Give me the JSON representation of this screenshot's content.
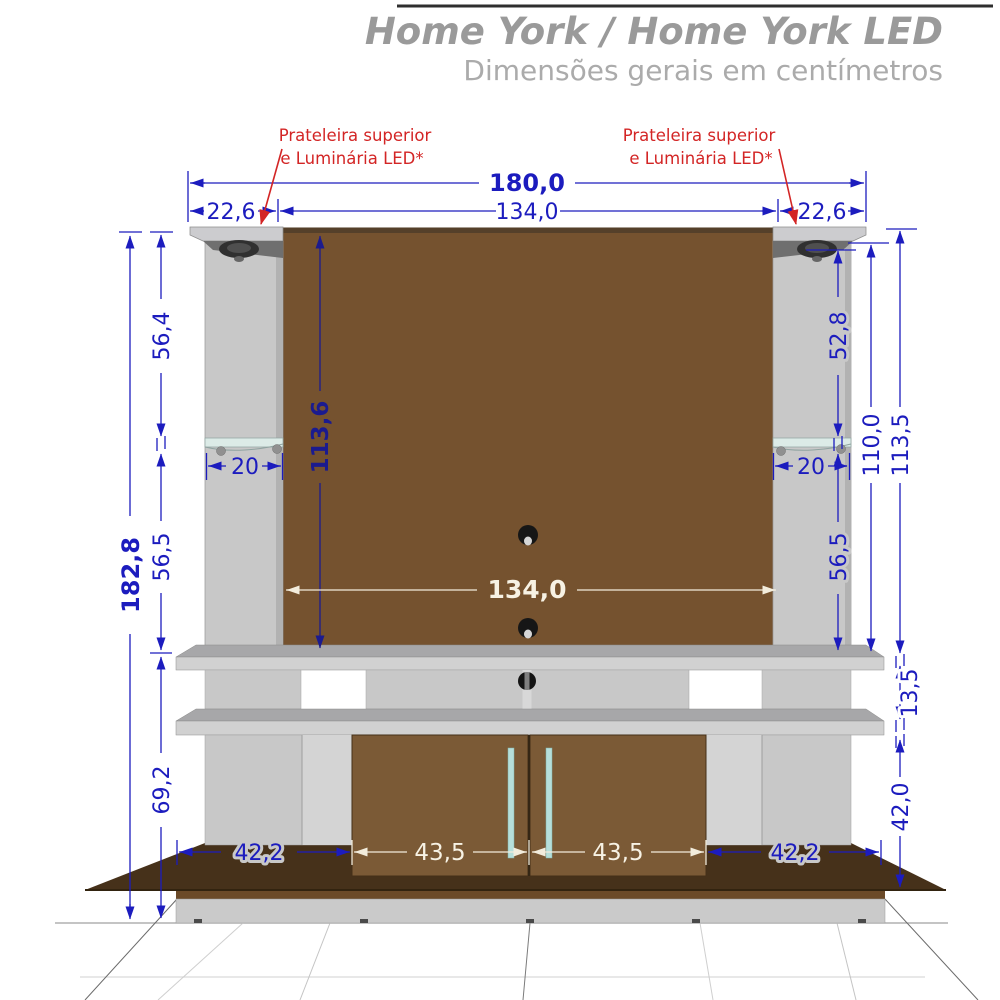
{
  "header": {
    "title": "Home York / Home York LED",
    "subtitle": "Dimensões gerais em centímetros"
  },
  "callouts": {
    "left": {
      "line1": "Prateleira superior",
      "line2": "e Luminária LED*"
    },
    "right": {
      "line1": "Prateleira superior",
      "line2": "e Luminária LED*"
    }
  },
  "dims": {
    "total_width": "180,0",
    "left_top_depth": "22,6",
    "top_panel_width": "134,0",
    "right_top_depth": "22,6",
    "left_upper_height": "56,4",
    "panel_height": "113,6",
    "right_upper_height": "52,8",
    "left_shelf_depth": "20",
    "right_shelf_depth": "20",
    "left_lower_height": "56,5",
    "right_lower_height": "56,5",
    "right_inner_total": "110,0",
    "right_outer_total": "113,5",
    "total_height": "182,8",
    "mid_panel_width": "134,0",
    "shelf_spacing": "13,5",
    "left_base_height": "69,2",
    "right_base_height": "42,0",
    "bottom_left_width": "42,2",
    "left_door_width": "43,5",
    "right_door_width": "43,5",
    "bottom_right_width": "42,2"
  },
  "colors": {
    "dimension_blue": "#1c1cbe",
    "panel_dark_blue": "#1b1b8f",
    "callout_red": "#d32525",
    "panel_brown": "#75522f",
    "door_brown": "#7b5a36",
    "cabinet_gray": "#c8c8c8",
    "handle_teal": "#b6dfda",
    "title_gray": "#9a9a9a"
  }
}
